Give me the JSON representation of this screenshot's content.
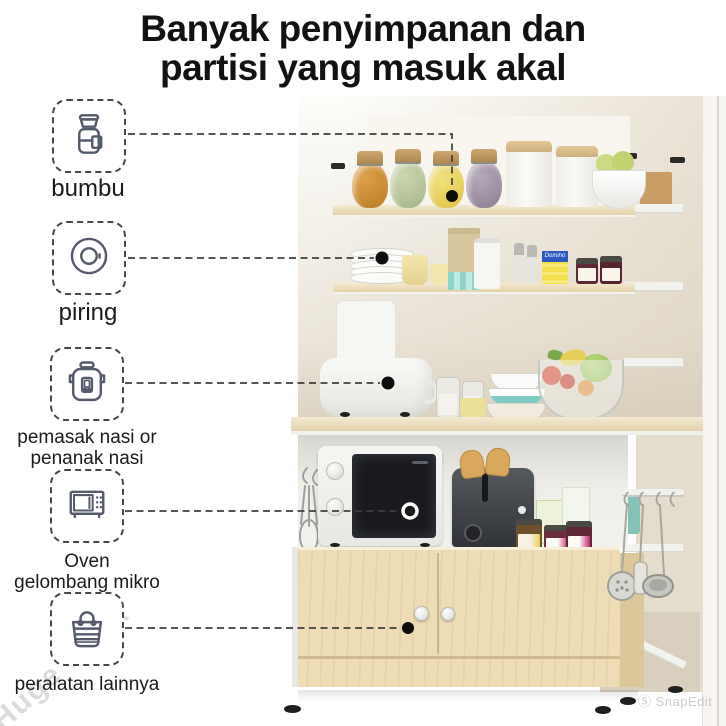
{
  "title": {
    "line1": "Banyak penyimpanan dan",
    "line2": "partisi yang masuk akal"
  },
  "callouts": [
    {
      "id": "bumbu",
      "icon": "spice-jar-icon",
      "label_line1": "bumbu",
      "label_line2": ""
    },
    {
      "id": "piring",
      "icon": "plate-icon",
      "label_line1": "piring",
      "label_line2": ""
    },
    {
      "id": "rice-cooker",
      "icon": "rice-cooker-icon",
      "label_line1": "pemasak nasi or",
      "label_line2": "penanak nasi"
    },
    {
      "id": "microwave",
      "icon": "microwave-icon",
      "label_line1": "Oven",
      "label_line2": "gelombang mikro"
    },
    {
      "id": "other-items",
      "icon": "tote-bag-icon",
      "label_line1": "peralatan lainnya",
      "label_line2": ""
    }
  ],
  "photo": {
    "sugar_box_label": "Domino"
  },
  "watermarks": {
    "diagonal": "Huge Rack",
    "corner": "Ⓢ SnapEdit"
  },
  "colors": {
    "title_text": "#121212",
    "connector": "#3f3f3f",
    "wood": "#eedcb6",
    "frame_white": "#f4f4f1",
    "wall_beige": "#e6ded0"
  }
}
